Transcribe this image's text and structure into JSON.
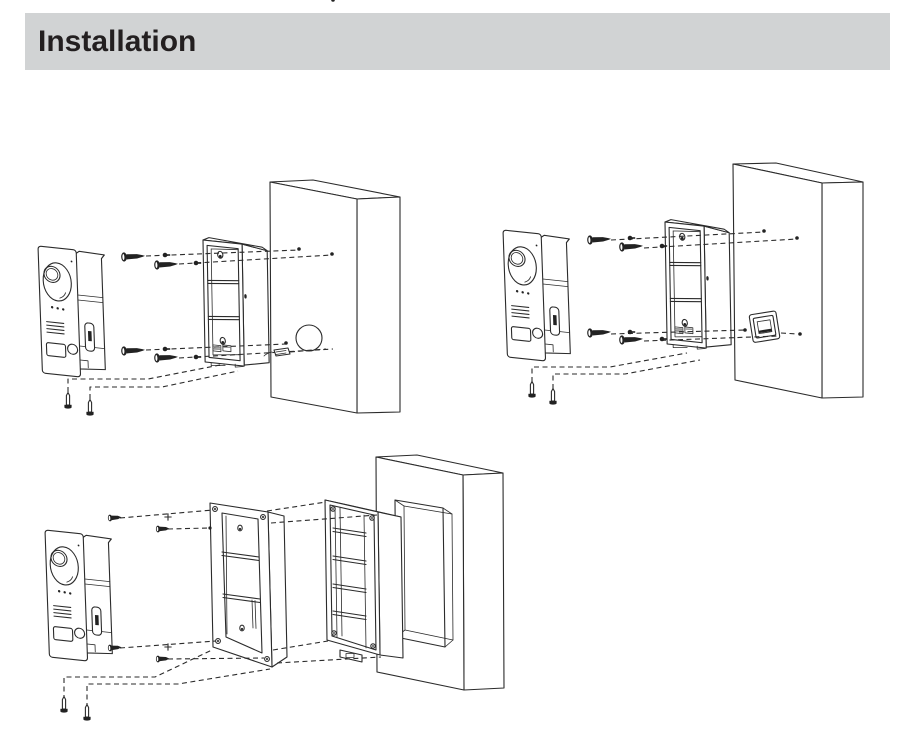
{
  "header": {
    "title": "Installation"
  },
  "colors": {
    "header_bg": "#d1d3d4",
    "title_text": "#231f20",
    "line_art": "#2b2b2b",
    "page_bg": "#ffffff"
  },
  "figures": [
    {
      "name": "surface-mount-on-wall-with-cable-hole"
    },
    {
      "name": "surface-mount-on-wall-with-86-junction-box"
    },
    {
      "name": "flush-mount-with-embedded-box"
    }
  ]
}
